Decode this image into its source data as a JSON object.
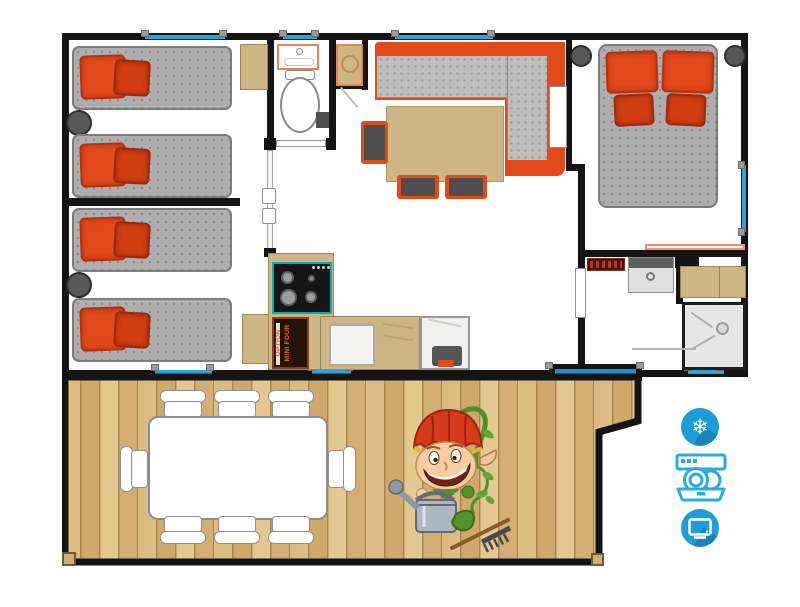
{
  "labels": {
    "option_line1": "OPTION",
    "option_line2": "MINI FOUR"
  },
  "amenities": [
    {
      "name": "air-conditioning",
      "icon": "snowflake-icon",
      "glyph": "❄"
    },
    {
      "name": "dishwasher",
      "icon": "dishwasher-icon"
    },
    {
      "name": "television",
      "icon": "tv-icon"
    }
  ],
  "colors": {
    "wall_black": "#141414",
    "accent_orange": "#E2491B",
    "mattress_gray": "#AEAEAE",
    "furniture_tan": "#CDB684",
    "window_blue": "#26A6DB",
    "amenity_icon_blue": "#1E9CD8",
    "dishwasher_outline_blue": "#29ABE2",
    "deck_wood": "#D9B97E",
    "hob_border_teal": "#00AEB8",
    "option_box_brown": "#241309"
  },
  "rooms": [
    {
      "name": "twin-bedroom-1",
      "beds": 2
    },
    {
      "name": "twin-bedroom-2",
      "beds": 2
    },
    {
      "name": "wc",
      "fixtures": [
        "washbasin",
        "toilet"
      ]
    },
    {
      "name": "living-kitchen",
      "furniture": [
        "corner-sofa",
        "dining-table",
        "hob",
        "mini-oven-option",
        "sink",
        "fridge"
      ]
    },
    {
      "name": "double-bedroom",
      "beds": 1
    },
    {
      "name": "shower-room",
      "fixtures": [
        "washbasin",
        "wardrobe",
        "shower"
      ]
    },
    {
      "name": "terrace",
      "furniture": [
        "outdoor-table",
        "outdoor-chairs"
      ]
    }
  ],
  "mascot": {
    "name": "gardener-elf-mascot",
    "items": [
      "watering-can",
      "rake",
      "vine"
    ]
  }
}
